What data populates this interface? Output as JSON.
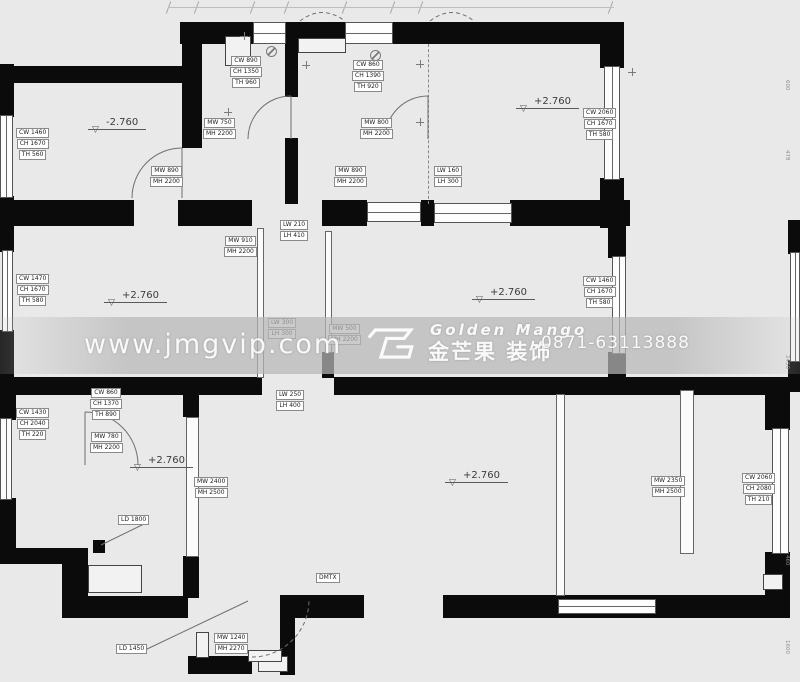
{
  "watermark": {
    "url": "www.jmgvip.com",
    "brand_en": "Golden Mango",
    "brand_cn": "金芒果 装饰",
    "phone": "0871-63113888",
    "logo": "golden-mango-emblem"
  },
  "levels": [
    {
      "x": 88,
      "y": 117,
      "text": "-2.760"
    },
    {
      "x": 516,
      "y": 96,
      "text": "+2.760"
    },
    {
      "x": 104,
      "y": 290,
      "text": "+2.760"
    },
    {
      "x": 472,
      "y": 287,
      "text": "+2.760"
    },
    {
      "x": 130,
      "y": 455,
      "text": "+2.760"
    },
    {
      "x": 445,
      "y": 470,
      "text": "+2.760"
    }
  ],
  "labels": [
    {
      "x": 16,
      "y": 128,
      "lines": [
        "CW 1460",
        "CH 1670",
        "TH 560"
      ]
    },
    {
      "x": 230,
      "y": 56,
      "lines": [
        "CW 890",
        "CH 1350",
        "TH 960"
      ]
    },
    {
      "x": 203,
      "y": 118,
      "lines": [
        "MW 750",
        "MH 2200"
      ]
    },
    {
      "x": 150,
      "y": 166,
      "lines": [
        "MW 890",
        "MH 2200"
      ]
    },
    {
      "x": 334,
      "y": 166,
      "lines": [
        "MW 890",
        "MH 2200"
      ]
    },
    {
      "x": 352,
      "y": 60,
      "lines": [
        "CW 860",
        "CH 1390",
        "TH 920"
      ]
    },
    {
      "x": 360,
      "y": 118,
      "lines": [
        "MW 800",
        "MH 2200"
      ]
    },
    {
      "x": 434,
      "y": 166,
      "lines": [
        "LW 160",
        "LH 300"
      ]
    },
    {
      "x": 583,
      "y": 108,
      "lines": [
        "CW 2060",
        "CH 1670",
        "TH 580"
      ]
    },
    {
      "x": 280,
      "y": 220,
      "lines": [
        "LW 210",
        "LH 410"
      ]
    },
    {
      "x": 224,
      "y": 236,
      "lines": [
        "MW 910",
        "MH 2200"
      ]
    },
    {
      "x": 16,
      "y": 274,
      "lines": [
        "CW 1470",
        "CH 1670",
        "TH 580"
      ]
    },
    {
      "x": 268,
      "y": 318,
      "lines": [
        "LW 300",
        "LH 300"
      ]
    },
    {
      "x": 328,
      "y": 324,
      "lines": [
        "MW 500",
        "MH 2200"
      ]
    },
    {
      "x": 583,
      "y": 276,
      "lines": [
        "CW 1460",
        "CH 1670",
        "TH 580"
      ]
    },
    {
      "x": 276,
      "y": 390,
      "lines": [
        "LW 250",
        "LH 400"
      ]
    },
    {
      "x": 90,
      "y": 388,
      "lines": [
        "CW 860",
        "CH 1370",
        "TH 890"
      ]
    },
    {
      "x": 16,
      "y": 408,
      "lines": [
        "CW 1430",
        "CH 2040",
        "TH 220"
      ]
    },
    {
      "x": 90,
      "y": 432,
      "lines": [
        "MW 780",
        "MH 2200"
      ]
    },
    {
      "x": 118,
      "y": 515,
      "lines": [
        "LD 1800"
      ]
    },
    {
      "x": 194,
      "y": 477,
      "lines": [
        "MW 2400",
        "MH 2500"
      ]
    },
    {
      "x": 651,
      "y": 476,
      "lines": [
        "MW 2350",
        "MH 2500"
      ]
    },
    {
      "x": 742,
      "y": 473,
      "lines": [
        "CW 2060",
        "CH 2080",
        "TH 210"
      ]
    },
    {
      "x": 116,
      "y": 644,
      "lines": [
        "LD 1450"
      ]
    },
    {
      "x": 214,
      "y": 633,
      "lines": [
        "MW 1240",
        "MH 2270"
      ]
    },
    {
      "x": 316,
      "y": 573,
      "lines": [
        "DMTX"
      ]
    }
  ],
  "walls": [
    [
      180,
      22,
      76,
      22
    ],
    [
      286,
      22,
      59,
      22
    ],
    [
      393,
      22,
      219,
      22
    ],
    [
      600,
      22,
      24,
      46
    ],
    [
      600,
      178,
      24,
      50
    ],
    [
      2,
      66,
      182,
      17
    ],
    [
      0,
      64,
      14,
      53
    ],
    [
      0,
      196,
      14,
      32
    ],
    [
      182,
      22,
      20,
      126
    ],
    [
      285,
      24,
      13,
      73
    ],
    [
      285,
      138,
      13,
      66
    ],
    [
      0,
      200,
      134,
      26
    ],
    [
      178,
      200,
      74,
      26
    ],
    [
      322,
      200,
      45,
      26
    ],
    [
      421,
      200,
      13,
      26
    ],
    [
      510,
      200,
      120,
      26
    ],
    [
      608,
      200,
      18,
      58
    ],
    [
      608,
      352,
      18,
      43
    ],
    [
      788,
      220,
      12,
      34
    ],
    [
      788,
      360,
      12,
      32
    ],
    [
      0,
      224,
      14,
      28
    ],
    [
      0,
      330,
      14,
      62
    ],
    [
      2,
      377,
      260,
      18
    ],
    [
      334,
      377,
      454,
      18
    ],
    [
      0,
      388,
      16,
      32
    ],
    [
      0,
      498,
      16,
      66
    ],
    [
      0,
      548,
      88,
      16
    ],
    [
      62,
      548,
      26,
      70
    ],
    [
      64,
      596,
      124,
      22
    ],
    [
      288,
      595,
      76,
      23
    ],
    [
      443,
      595,
      330,
      23
    ],
    [
      765,
      390,
      25,
      40
    ],
    [
      765,
      552,
      25,
      66
    ],
    [
      280,
      595,
      15,
      80
    ],
    [
      188,
      656,
      64,
      18
    ],
    [
      183,
      392,
      16,
      25
    ],
    [
      183,
      556,
      16,
      42
    ],
    [
      322,
      352,
      12,
      26
    ],
    [
      93,
      540,
      12,
      13
    ]
  ],
  "windows_h": [
    [
      253,
      22,
      33,
      22
    ],
    [
      345,
      22,
      48,
      22
    ],
    [
      558,
      599,
      98,
      15
    ],
    [
      434,
      203,
      78,
      20
    ],
    [
      367,
      202,
      54,
      20
    ]
  ],
  "windows_v": [
    [
      604,
      66,
      16,
      114
    ],
    [
      0,
      115,
      13,
      83
    ],
    [
      2,
      250,
      11,
      82
    ],
    [
      0,
      418,
      12,
      82
    ],
    [
      612,
      256,
      14,
      98
    ],
    [
      790,
      252,
      10,
      110
    ],
    [
      772,
      428,
      17,
      126
    ]
  ],
  "partitions": [
    [
      257,
      228,
      7,
      150
    ],
    [
      325,
      231,
      7,
      122
    ],
    [
      186,
      417,
      13,
      140
    ],
    [
      556,
      394,
      9,
      202
    ],
    [
      680,
      390,
      14,
      164
    ]
  ],
  "dashes": [
    [
      428,
      44,
      160
    ]
  ],
  "niches": [
    [
      225,
      36,
      26,
      30
    ],
    [
      298,
      38,
      48,
      15
    ],
    [
      88,
      565,
      54,
      28
    ],
    [
      258,
      656,
      30,
      16
    ],
    [
      763,
      574,
      20,
      16
    ],
    [
      196,
      632,
      13,
      26
    ],
    [
      248,
      650,
      34,
      12
    ]
  ],
  "fixtures": {
    "circles": [
      [
        266,
        46
      ],
      [
        370,
        50
      ]
    ],
    "plus": [
      [
        240,
        32
      ],
      [
        302,
        61
      ],
      [
        416,
        60
      ],
      [
        416,
        118
      ],
      [
        224,
        108
      ],
      [
        628,
        68
      ]
    ]
  },
  "arcs_solid": [
    "M85,412 A53,53 0 0 1 138,465",
    "M85,412 L85,465",
    "M132,198 A50,50 0 0 1 182,148",
    "M182,148 L182,198",
    "M248,139 A43,43 0 0 1 291,96",
    "M291,96 L291,139",
    "M385,139 A43,43 0 0 1 428,96",
    "M428,96 L428,139"
  ],
  "arcs_dashed": [
    "M252,657 A57,57 0 0 0 309,600",
    "M300,21 Q322,4 345,21",
    "M430,21 Q452,4 474,21"
  ],
  "leaders": [
    "M146,523 L101,545",
    "M145,650 L248,601"
  ],
  "edge_dims": [
    {
      "y": 80,
      "text": "600"
    },
    {
      "y": 150,
      "text": "478"
    },
    {
      "y": 355,
      "text": "2450"
    },
    {
      "y": 555,
      "text": "460"
    },
    {
      "y": 640,
      "text": "1600"
    }
  ],
  "ticks": [
    168,
    196,
    252,
    286,
    344,
    392,
    420,
    610
  ]
}
